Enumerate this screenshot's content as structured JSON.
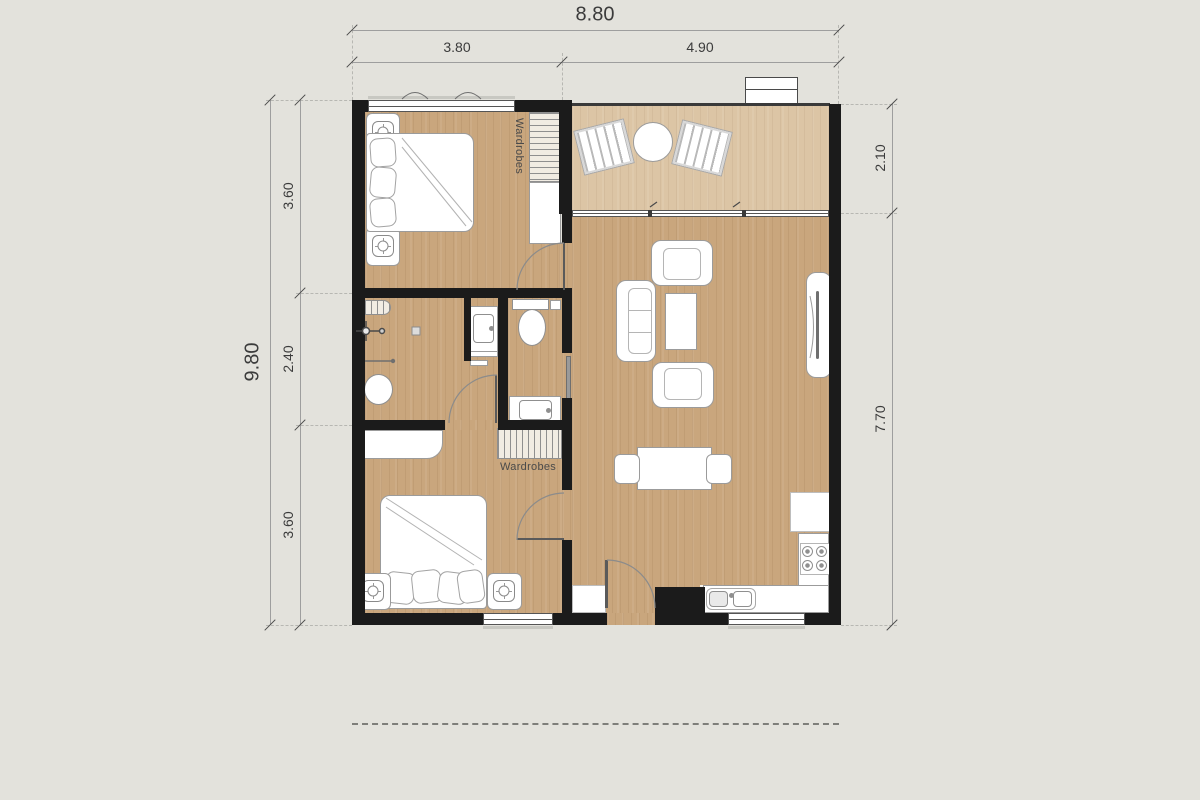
{
  "floor_plan": {
    "dimensions": {
      "top_overall": "8.80",
      "top_segments": [
        "3.80",
        "4.90"
      ],
      "left_overall": "9.80",
      "left_segments": [
        "3.60",
        "2.40",
        "3.60"
      ],
      "right_segments": [
        "2.10",
        "7.70"
      ]
    },
    "labels": {
      "wardrobe_bedroom1": "Wardrobes",
      "wardrobe_bedroom2": "Wardrobes"
    },
    "colors": {
      "background": "#e3e2dc",
      "wall": "#1b1b1b",
      "floor_wood": "#c9a67d",
      "floor_balcony": "#dcc5a5",
      "fixture_outline": "#9b9b9b",
      "dimension_text": "#3b3b3b"
    }
  }
}
